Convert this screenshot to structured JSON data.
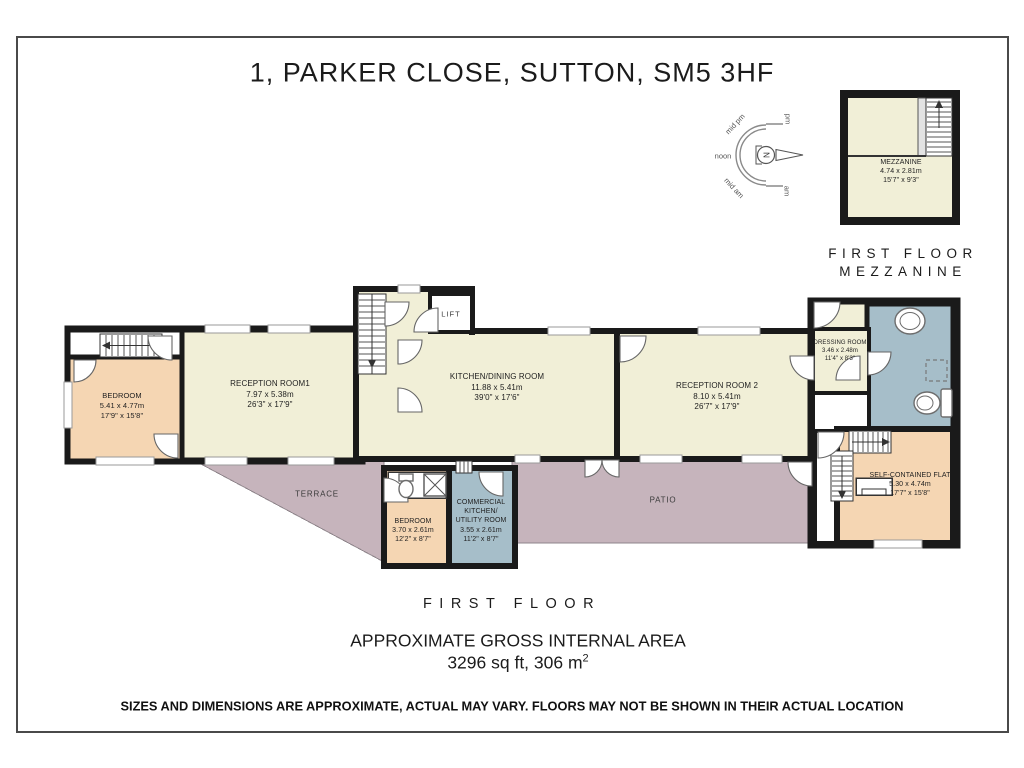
{
  "title": "1, PARKER CLOSE, SUTTON, SM5 3HF",
  "colors": {
    "wall": "#1a1a1a",
    "cream": "#f1efd7",
    "peach": "#f5d6b3",
    "blue": "#a6bec9",
    "mauve": "#c6b4bc",
    "ink": "#1f1f1f"
  },
  "compass": {
    "north": "N",
    "pm": "pm",
    "mid_pm": "mid pm",
    "noon": "noon",
    "mid_am": "mid am",
    "am": "am"
  },
  "mezzanine": {
    "name": "MEZZANINE",
    "metric": "4.74 x 2.81m",
    "imperial": "15'7\" x 9'3\"",
    "caption_line1": "FIRST FLOOR",
    "caption_line2": "MEZZANINE"
  },
  "rooms": {
    "bedroom_left": {
      "name": "BEDROOM",
      "metric": "5.41 x 4.77m",
      "imperial": "17'9\" x 15'8\""
    },
    "reception1": {
      "name": "RECEPTION ROOM1",
      "metric": "7.97 x 5.38m",
      "imperial": "26'3\" x 17'9\""
    },
    "kitchen": {
      "name": "KITCHEN/DINING ROOM",
      "metric": "11.88 x 5.41m",
      "imperial": "39'0\" x 17'6\""
    },
    "reception2": {
      "name": "RECEPTION ROOM 2",
      "metric": "8.10 x 5.41m",
      "imperial": "26'7\" x 17'9\""
    },
    "dressing": {
      "name": "DRESSING ROOM",
      "metric": "3.46 x 2.48m",
      "imperial": "11'4\" x 8'3\""
    },
    "flat": {
      "name": "SELF-CONTAINED FLAT",
      "metric": "5.30 x 4.74m",
      "imperial": "17'7\" x 15'8\""
    },
    "bedroom_bottom": {
      "name": "BEDROOM",
      "metric": "3.70 x 2.61m",
      "imperial": "12'2\" x 8'7\""
    },
    "commercial_kitchen": {
      "name": "COMMERCIAL KITCHEN/ UTILITY ROOM",
      "metric": "3.55 x 2.61m",
      "imperial": "11'2\" x 8'7\""
    },
    "terrace": {
      "name": "TERRACE"
    },
    "patio": {
      "name": "PATIO"
    },
    "lift": {
      "name": "LIFT"
    }
  },
  "footer": {
    "floor_caption": "FIRST FLOOR",
    "area_title": "APPROXIMATE GROSS INTERNAL AREA",
    "area_value": "3296 sq ft, 306 m",
    "area_sup": "2",
    "disclaimer": "SIZES AND DIMENSIONS ARE APPROXIMATE, ACTUAL MAY VARY. FLOORS MAY NOT BE SHOWN IN THEIR ACTUAL LOCATION"
  }
}
